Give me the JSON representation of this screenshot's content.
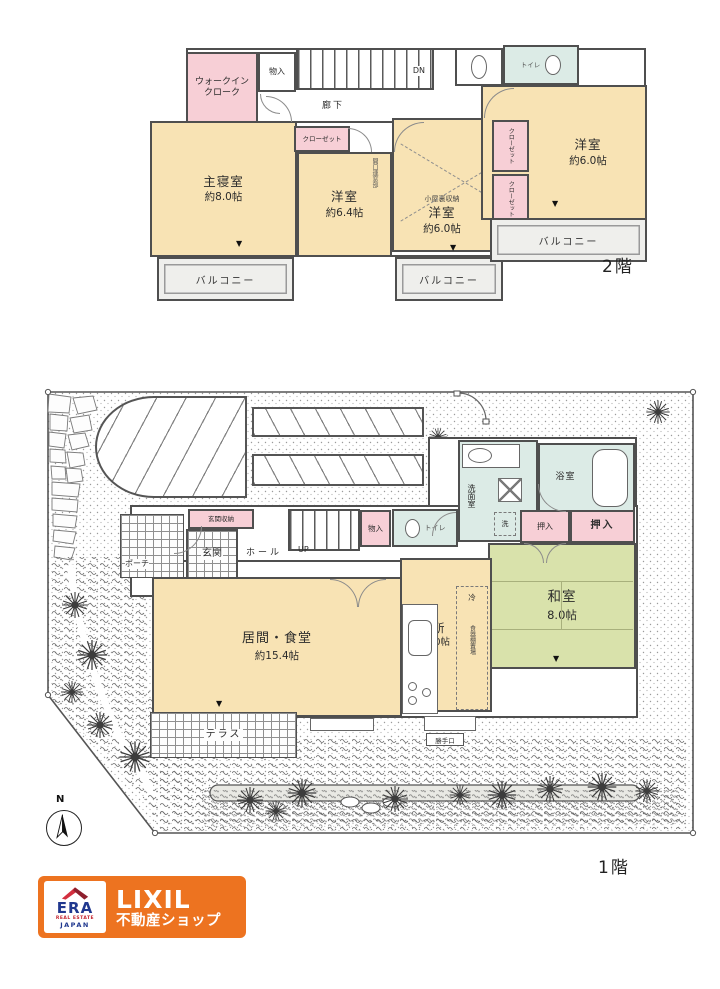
{
  "floor2": {
    "label": "2階",
    "walk_in_closet": "ウォークインクローク",
    "storage": "物入",
    "corridor": "廊下",
    "stairs_down": "DN",
    "closet": "クローゼット",
    "toilet": "トイレ",
    "master": {
      "name": "主寝室",
      "size": "約8.0帖"
    },
    "western_64": {
      "name": "洋室",
      "size": "約6.4帖"
    },
    "western_60_mid": {
      "name": "洋室",
      "size": "約6.0帖",
      "attic": "小屋裏収納"
    },
    "western_60_right": {
      "name": "洋室",
      "size": "約6.0帖"
    },
    "balcony": "バルコニー",
    "wall_note": "開口連窓部"
  },
  "floor1": {
    "label": "1階",
    "entrance_storage": "玄関収納",
    "entrance": "玄関",
    "porch": "ポーチ",
    "hall": "ホール",
    "stairs_up": "UP",
    "storage": "物入",
    "toilet": "トイレ",
    "washroom": "洗面室",
    "washer": "洗",
    "bath": "浴室",
    "oshiire": "押入",
    "japanese": {
      "name": "和室",
      "size": "8.0帖"
    },
    "kitchen": {
      "name": "台所",
      "size": "約5.0帖"
    },
    "fridge": "冷",
    "cupboard": "食器棚置場",
    "living": {
      "name": "居間・食堂",
      "size": "約15.4帖"
    },
    "terrace": "テラス",
    "back_door": "勝手口",
    "compass_north": "N"
  },
  "branding": {
    "era": "ERA",
    "real_estate": "REAL ESTATE",
    "japan": "JAPAN",
    "lixil": "LIXIL",
    "shop": "不動産ショップ"
  },
  "markers": {
    "down_triangle": "▼"
  },
  "colors": {
    "room_cream": "#f8e3b4",
    "closet_pink": "#f7cfd6",
    "wet_blue": "#dcebe6",
    "tatami_green": "#d9e2ab",
    "wall": "#4f4f4f",
    "brand_orange": "#ed7320",
    "era_blue": "#20388f",
    "era_red": "#c4242f"
  }
}
